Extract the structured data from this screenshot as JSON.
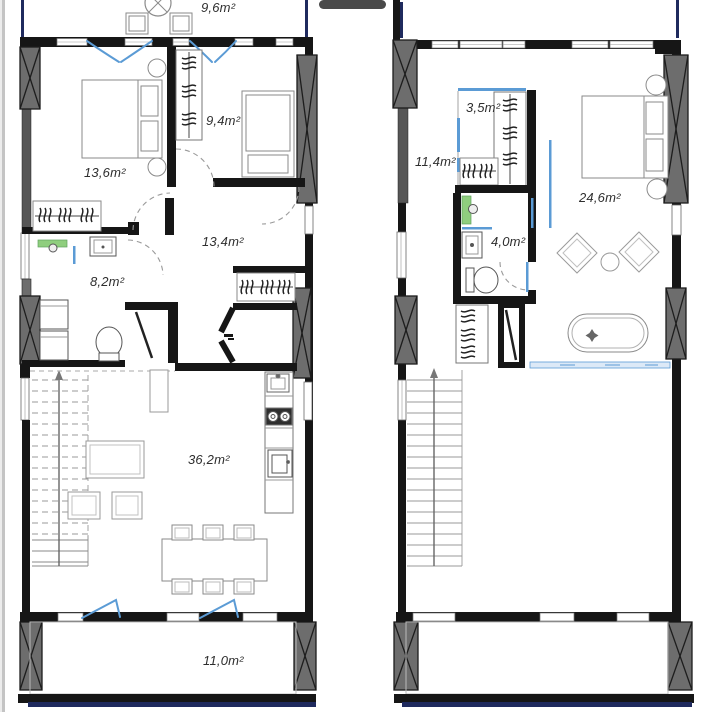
{
  "title": "Two-storey apartment floor plans",
  "plans": {
    "left": {
      "labels": {
        "terrace_top": "9,6m²",
        "bedroom_large": "13,6m²",
        "bedroom_small": "9,4m²",
        "hallway": "13,4m²",
        "bathroom": "8,2m²",
        "living_room": "36,2m²",
        "balcony_bottom": "11,0m²"
      }
    },
    "right": {
      "labels": {
        "closet": "3,5m²",
        "dressing_room": "11,4m²",
        "bedroom_master": "24,6m²",
        "bathroom": "4,0m²"
      }
    }
  },
  "colors": {
    "wall": "#161616",
    "column_gray": "#6d6d6d",
    "wall_dark_gray": "#565656",
    "window_arc_blue": "#5b9bd5",
    "railing_navy": "#1f2a5e",
    "fixture_green": "#8fce7e",
    "tile_blue_fill": "#dce9f7",
    "furniture_line": "#8a8a8a"
  }
}
